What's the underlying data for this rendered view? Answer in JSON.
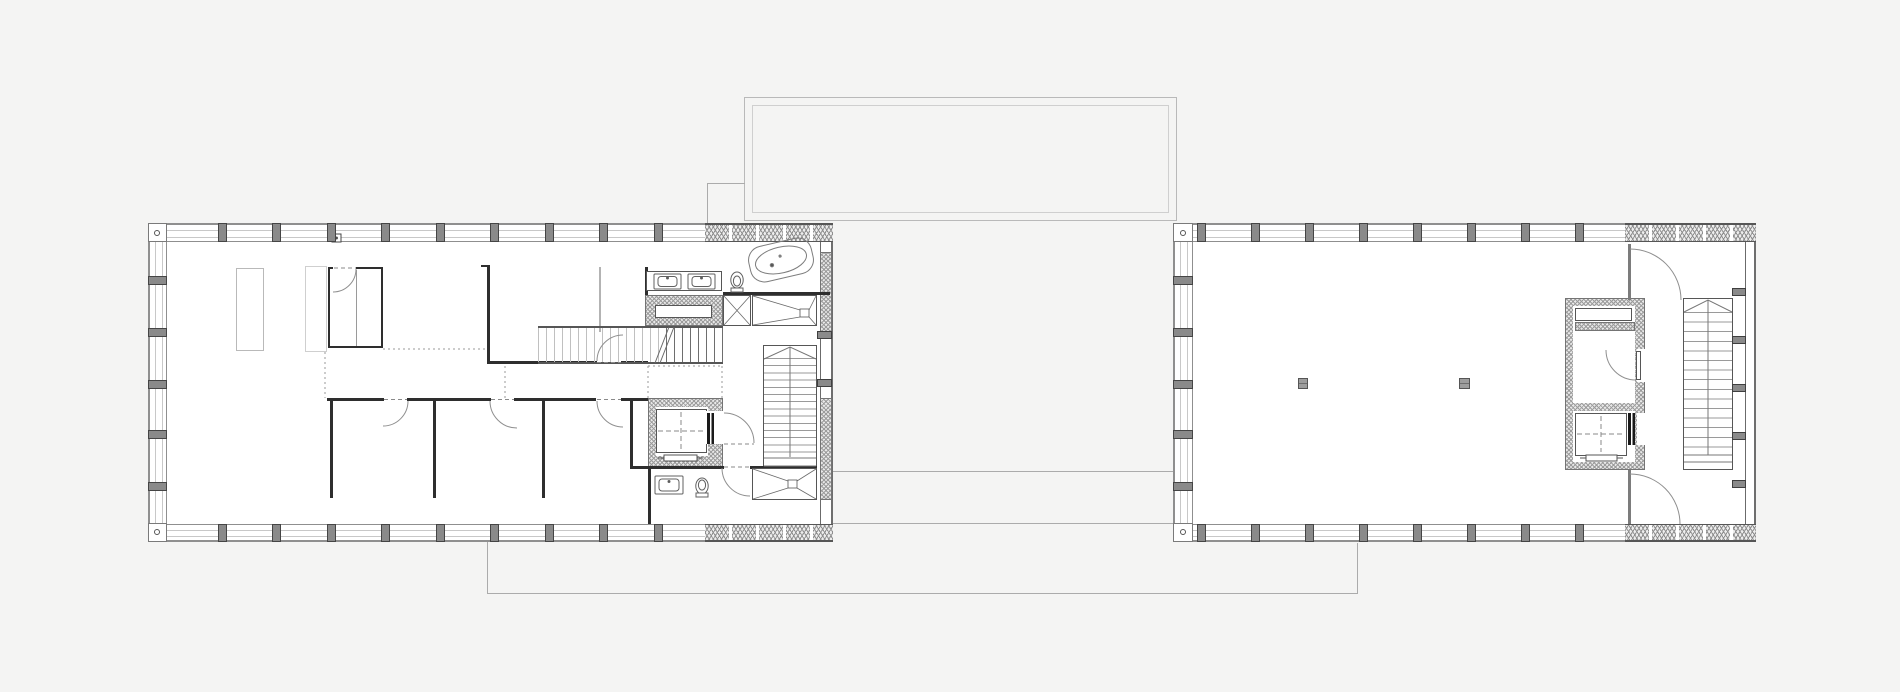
{
  "meta": {
    "title": "Architectural floor plan drawing: two elongated rectangular building volumes with glazed facades, connected by light outline lines of a roof terrace above and a deck below; no visible text labels",
    "drawing_type": "technical plan drawing",
    "visible_text": ""
  },
  "colors": {
    "bg": "#f4f4f3",
    "paper": "#ffffff",
    "wall": "#2e2e2e",
    "lineMid": "#565656",
    "lineLight": "#b9b9b9",
    "facadeLine": "#8f8f8f",
    "glazingLine": "#c8c8c8",
    "mullion": "#8a8a8a",
    "hatchLine": "#8f8f8f",
    "connector": "#ababab",
    "dotted": "#9a9a9a",
    "column": "#9e9e9e"
  },
  "left_building": {
    "label": "west volume (residential floor)",
    "rooms": [
      "open living area",
      "wardrobe closet",
      "room 1",
      "room 2",
      "room 3",
      "bathroom north",
      "bathroom south",
      "elevator",
      "interior stair",
      "main stair"
    ],
    "fixtures": [
      "double vanity with two sinks",
      "toilet north",
      "freestanding bathtub",
      "walk-in shower north",
      "duct shaft hatched",
      "cross-braced shaft box",
      "elevator car with door",
      "sink south",
      "toilet south",
      "walk-in shower south"
    ]
  },
  "right_building": {
    "label": "east volume (open hall floor)",
    "rooms": [
      "open hall",
      "storage core with shelf",
      "elevator",
      "stair"
    ],
    "free_columns": 2,
    "doors": [
      "swing door north of core",
      "door inside core",
      "swing door south of core"
    ]
  },
  "connectors": {
    "roof_outline": "double rectangle above, centered between volumes",
    "bridge_lines": 2,
    "deck_outline": "large open rectangle below both volumes"
  },
  "repeats": [
    {
      "name": "lb-top-mullion",
      "axis": "x",
      "positions": [
        218,
        272,
        327,
        381,
        436,
        490,
        545,
        599,
        654
      ],
      "fixed": 223,
      "w": 9,
      "h": 19
    },
    {
      "name": "lb-bottom-mullion",
      "axis": "x",
      "positions": [
        218,
        272,
        327,
        381,
        436,
        490,
        545,
        599,
        654
      ],
      "fixed": 524,
      "w": 9,
      "h": 18
    },
    {
      "name": "lb-left-mullion",
      "axis": "y",
      "positions": [
        276,
        328,
        380,
        430,
        482
      ],
      "fixed": 148,
      "w": 19,
      "h": 9
    },
    {
      "name": "rb-top-mullion",
      "axis": "x",
      "positions": [
        1197,
        1251,
        1305,
        1359,
        1413,
        1467,
        1521,
        1575
      ],
      "fixed": 223,
      "w": 9,
      "h": 19
    },
    {
      "name": "rb-bottom-mullion",
      "axis": "x",
      "positions": [
        1197,
        1251,
        1305,
        1359,
        1413,
        1467,
        1521,
        1575
      ],
      "fixed": 524,
      "w": 9,
      "h": 18
    },
    {
      "name": "rb-left-mullion",
      "axis": "y",
      "positions": [
        276,
        328,
        380,
        430,
        482
      ],
      "fixed": 1173,
      "w": 20,
      "h": 9
    },
    {
      "name": "rb-right-pier",
      "axis": "y",
      "positions": [
        288,
        336,
        384,
        432,
        480
      ],
      "fixed": 1732,
      "w": 14,
      "h": 8,
      "cls": "pier"
    },
    {
      "name": "lb-right-pier",
      "axis": "y",
      "positions": [
        331,
        379
      ],
      "fixed": 817,
      "w": 15,
      "h": 8,
      "cls": "pier"
    }
  ]
}
